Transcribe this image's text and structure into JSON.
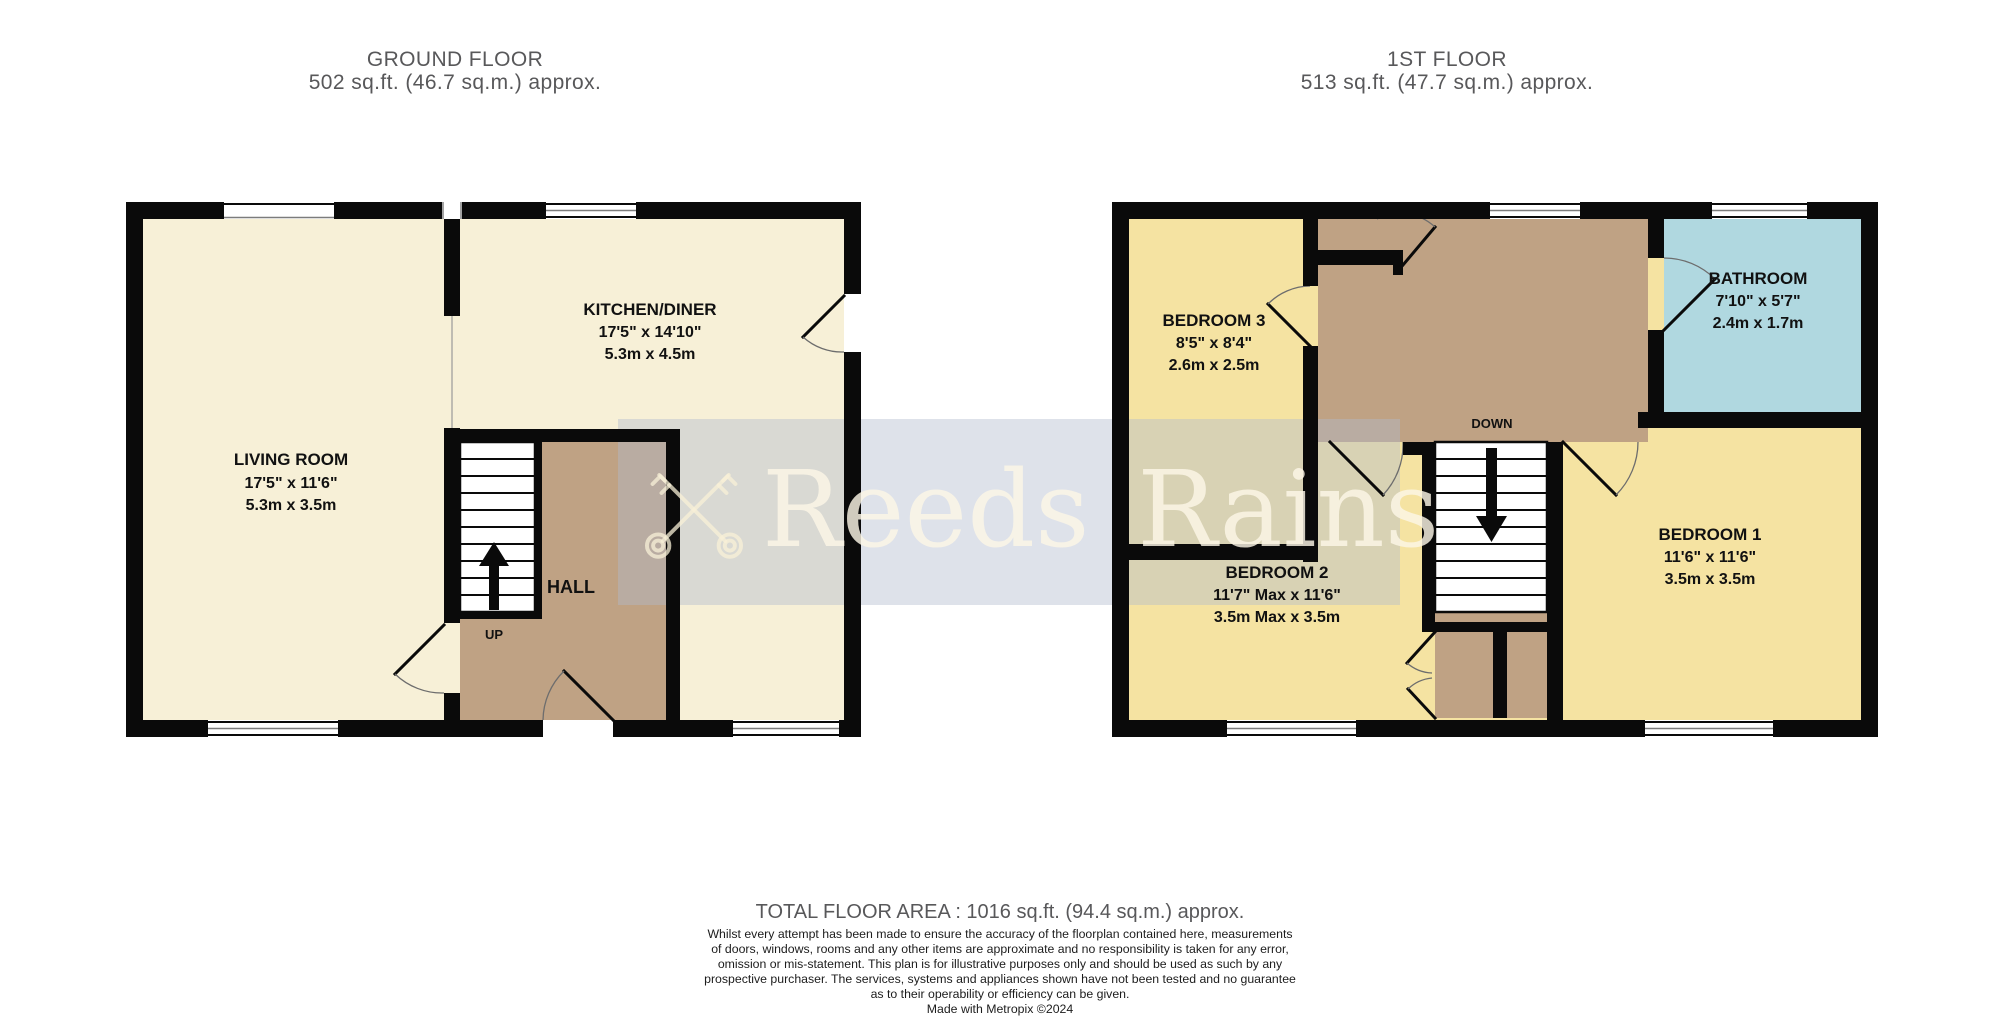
{
  "ground_floor": {
    "title": "GROUND FLOOR",
    "area": "502 sq.ft. (46.7 sq.m.) approx.",
    "rooms": {
      "living_room": {
        "name": "LIVING ROOM",
        "size_imperial": "17'5\"  x 11'6\"",
        "size_metric": "5.3m  x 3.5m"
      },
      "kitchen_diner": {
        "name": "KITCHEN/DINER",
        "size_imperial": "17'5\"  x 14'10\"",
        "size_metric": "5.3m  x 4.5m"
      },
      "hall": {
        "name": "HALL"
      }
    },
    "labels": {
      "stairs": "UP"
    }
  },
  "first_floor": {
    "title": "1ST FLOOR",
    "area": "513 sq.ft. (47.7 sq.m.) approx.",
    "rooms": {
      "bedroom_1": {
        "name": "BEDROOM 1",
        "size_imperial": "11'6\"  x 11'6\"",
        "size_metric": "3.5m  x 3.5m"
      },
      "bedroom_2": {
        "name": "BEDROOM 2",
        "size_imperial": "11'7\" Max x 11'6\"",
        "size_metric": "3.5m Max x 3.5m"
      },
      "bedroom_3": {
        "name": "BEDROOM 3",
        "size_imperial": "8'5\"  x 8'4\"",
        "size_metric": "2.6m  x 2.5m"
      },
      "bathroom": {
        "name": "BATHROOM",
        "size_imperial": "7'10\"  x 5'7\"",
        "size_metric": "2.4m  x 1.7m"
      }
    },
    "labels": {
      "stairs": "DOWN"
    }
  },
  "watermark": {
    "brand": "Reeds Rains",
    "logo": "crossed-keys-icon"
  },
  "footer": {
    "total": "TOTAL FLOOR AREA : 1016 sq.ft. (94.4 sq.m.) approx.",
    "disclaimer": [
      "Whilst every attempt has been made to ensure the accuracy of the floorplan contained here, measurements",
      "of doors, windows, rooms and any other items are approximate and no responsibility is taken for any error,",
      "omission or mis-statement. This plan is for illustrative purposes only and should be used as such by any",
      "prospective purchaser. The services, systems and appliances shown have not been tested and no guarantee",
      "as to their operability or efficiency can be given."
    ],
    "credit": "Made with Metropix ©2024"
  },
  "colors": {
    "room_cream": "#f7f0d7",
    "bedroom_yellow": "#f5e3a2",
    "hall_brown": "#bfa284",
    "bathroom_blue": "#b0d8e0",
    "wall_black": "#0a0a0a",
    "title_grey": "#58585a",
    "watermark_band": "rgba(177,186,206,0.42)",
    "watermark_text": "rgba(252,246,230,0.82)"
  }
}
